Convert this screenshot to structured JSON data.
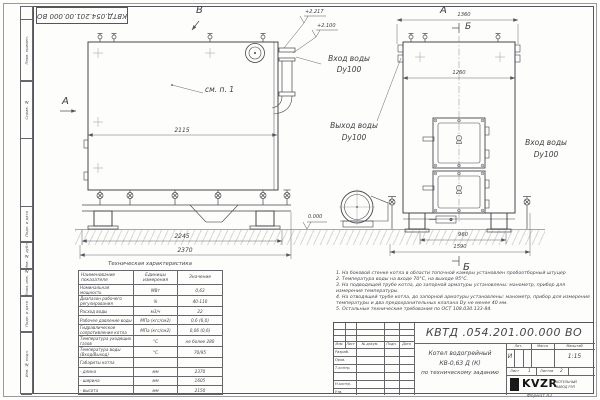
{
  "colors": {
    "line": "#46464c",
    "paper": "#fdfdfc",
    "hatch": "#d7d7d7",
    "logo_black": "#19191c"
  },
  "stamp_top": {
    "doc_number": "КВТД.054.201.00.000  ВО"
  },
  "margin": {
    "cells": [
      "Перв. примен.",
      "Справ. №",
      "Подп. и дата",
      "Инв. № дубл.",
      "Взам. инв. №",
      "Подп. и дата",
      "Инв. № подл."
    ]
  },
  "front_view": {
    "view_letter_top": "В",
    "view_letter_left": "А",
    "callout": "см. п. 1",
    "dim_width": "2115",
    "dim_base": "2245",
    "dim_overall": "2370",
    "elev_top": "+2.217",
    "elev_mid": "+2.100",
    "elev_zero": "0.000"
  },
  "side_view": {
    "view_letter": "А",
    "section_letter_top": "Б",
    "section_letter_bottom": "Б",
    "dim_top": "1360",
    "dim_width": "1260",
    "dim_base": "960",
    "dim_overall": "1590"
  },
  "pipe_labels": {
    "inlet_front_l1": "Вход воды",
    "inlet_front_l2": "Dy100",
    "outlet_l1": "Выход воды",
    "outlet_l2": "Dy100",
    "inlet_side_l1": "Вход воды",
    "inlet_side_l2": "Dy100"
  },
  "tech_table": {
    "title": "Техническая характеристика",
    "headers": [
      "Наименование показателя",
      "Единицы измерения",
      "Значение"
    ],
    "rows": [
      {
        "name": "Номинальная мощность",
        "unit": "МВт",
        "value": "0,63"
      },
      {
        "name": "Диапазон рабочего регулирования",
        "unit": "%",
        "value": "40-110"
      },
      {
        "name": "Расход воды",
        "unit": "м3/ч",
        "value": "22"
      },
      {
        "name": "Рабочее давление воды",
        "unit": "МПа (кгс/см2)",
        "value": "0,6 (6,0)"
      },
      {
        "name": "Гидравлическое сопротивление котла",
        "unit": "МПа (кгс/см2)",
        "value": "0,06 (0,6)"
      },
      {
        "name": "Температура уходящих газов",
        "unit": "°С",
        "value": "не более 280"
      },
      {
        "name": "Температура воды (Вход/Выход)",
        "unit": "°С",
        "value": "70/95"
      },
      {
        "name": "Габариты котла",
        "unit": "",
        "value": ""
      },
      {
        "name": "- длина",
        "unit": "мм",
        "value": "2370"
      },
      {
        "name": "- ширина",
        "unit": "мм",
        "value": "1605"
      },
      {
        "name": "- высота",
        "unit": "мм",
        "value": "2150"
      }
    ]
  },
  "notes": {
    "items": [
      "1. На боковой стенке котла в области топочной камеры установлен пробоотборный штуцер",
      "2. Температура воды на входе 70°С, на выходе 95°С.",
      "3. На подводящей трубе котла, до запорной арматуры установлены: манометр, прибор для измерения температуры.",
      "4. На отводящей трубе котла, до запорной арматуры установлены: манометр, прибор для измерения температуры и два предохранительных клапана Dy не менее 40 мм.",
      "5. Остальные технические требования по ОСТ 108.030.133-84."
    ]
  },
  "title_block": {
    "doc_number": "КВТД .054.201.00.000  ВО",
    "cols": {
      "izm": "Изм.",
      "list": "Лист",
      "n_dokum": "№ докум.",
      "podp": "Подп.",
      "data": "Дата"
    },
    "rows": {
      "razrab": "Разраб.",
      "prov": "Пров.",
      "t_kontr": "Т.контр.",
      "n_kontr": "Н.контр.",
      "utv": "Утв."
    },
    "name_l1": "Котел водогрейный",
    "name_l2": "КВ-0,63 Д (К)",
    "name_l3": "по техническому заданию",
    "lit_label": "Лит.",
    "lit_value": "И",
    "mass_label": "Масса",
    "scale_label": "Масштаб",
    "scale_value": "1:15",
    "sheet_label": "Лист",
    "sheet_value": "1",
    "sheets_label": "Листов",
    "sheets_value": "2",
    "logo_text": "KVZR",
    "logo_sub1": "КОТЕЛЬНЫЙ",
    "logo_sub2": "ЗАВОД РЭП",
    "format": "Формат  А3"
  }
}
